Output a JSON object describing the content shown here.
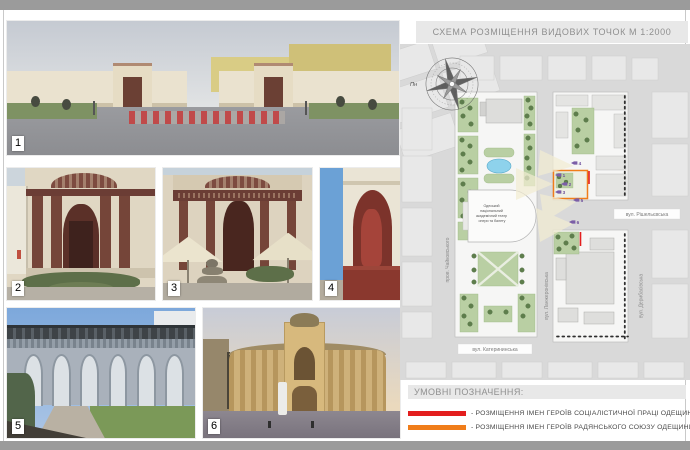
{
  "title": "СХЕМА РОЗМІЩЕННЯ ВИДОВИХ ТОЧОК М 1:2000",
  "photos": [
    {
      "number": "1"
    },
    {
      "number": "2"
    },
    {
      "number": "3"
    },
    {
      "number": "4"
    },
    {
      "number": "5"
    },
    {
      "number": "6"
    }
  ],
  "map": {
    "north_label": "Пн",
    "theater": {
      "name": "Одеський національний академічний театр опери та балету",
      "lines": [
        "Одеський",
        "національний",
        "академічний театр",
        "опери та балету"
      ]
    },
    "streets": {
      "chaikovskoho": "пров. Чайковського",
      "rishelievska": "вул. Рішельєвська",
      "lanzheronivska": "вул. Ланжеронівська",
      "derybasivska": "вул. Дерибасівська",
      "katerynynska": "вул. Катерининська"
    },
    "viewpoints": [
      "1",
      "2",
      "3",
      "4",
      "5",
      "6"
    ],
    "marker_color": "#7b5ea7",
    "green_color": "#b9cfa3",
    "pond_color": "#8ed2ec"
  },
  "legend": {
    "heading": "УМОВНІ ПОЗНАЧЕННЯ:",
    "items": [
      {
        "color": "#e31e1e",
        "label": "- РОЗМІЩЕННЯ ІМЕН ГЕРОЇВ СОЦІАЛІСТИЧНОЇ ПРАЦІ ОДЕЩИНИ"
      },
      {
        "color": "#f07d1a",
        "label": "- РОЗМІЩЕННЯ ІМЕН ГЕРОЇВ РАДЯНСЬКОГО СОЮЗУ ОДЕЩИНИ"
      }
    ]
  }
}
